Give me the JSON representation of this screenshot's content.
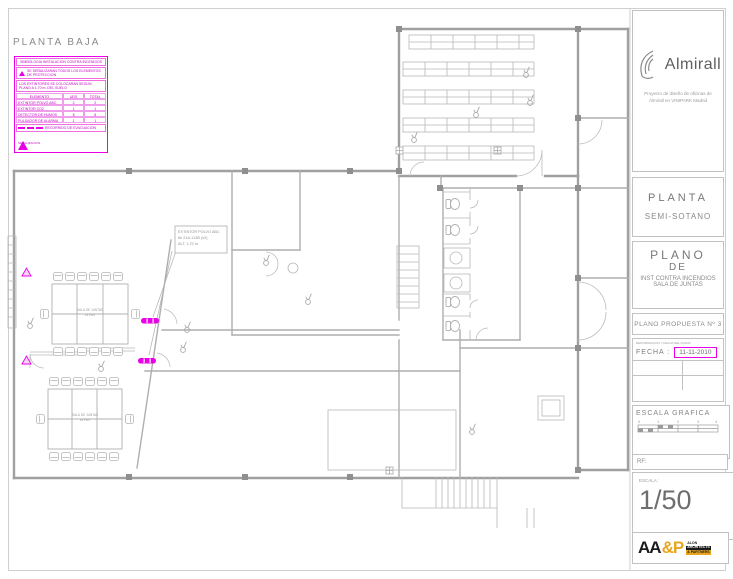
{
  "sheet_title": "PLANTA BAJA",
  "legend": {
    "title": "SIMBOLOGIA INSTALACION CONTRA INCENDIOS",
    "warn_text": "SE SEÑALIZARAN TODOS LOS ELEMENTOS DE PROTECCION",
    "note_text": "LOS EXTINTORES SE COLOCARAN SEGUN PLANO A 1,70 m. DEL SUELO",
    "headers": [
      "ELEMENTO",
      "UDS",
      "TOTAL"
    ],
    "rows": [
      [
        "EXTINTOR POLVO ABC",
        "2",
        "2"
      ],
      [
        "EXTINTOR CO2",
        "1",
        "1"
      ],
      [
        "DETECTOR DE HUMOS",
        "8",
        "8"
      ],
      [
        "PULSADOR DE ALARMA",
        "1",
        "1"
      ]
    ],
    "evac_label": "RECORRIDO DE EVACUACION",
    "tri_caption": "SEÑALIZACION"
  },
  "plan": {
    "callout_lines": [
      "EXTINTOR POLVO ABC",
      "6e 21A-113B (x2)",
      "ALT. 1,70 m"
    ],
    "table1_label": "SALA DE JUNTAS",
    "table1_sub": "14 PAX",
    "table2_label": "SALA DE JUNTAS",
    "table2_sub": "14 PAX"
  },
  "titleblock": {
    "brand": {
      "name": "Almirall",
      "tagline1": "Proyecto de diseño de oficinas de",
      "tagline2": "Almirall en VINIPARK Madrid"
    },
    "planta": {
      "line1": "PLANTA",
      "line2": "SEMI-SOTANO"
    },
    "plano": {
      "line1": "PLANO",
      "line2": "DE",
      "line3": "INST CONTRA INCENDIOS",
      "line4": "SALA DE JUNTAS"
    },
    "proposal": "PLANO PROPUESTA Nº 3",
    "fecha": {
      "small": "DENOMINACION Y FECHA DEL PLANO",
      "label": "FECHA :",
      "value": "11-11-2010"
    },
    "escala_grafica": {
      "label": "ESCALA GRAFICA",
      "ticks": [
        "0",
        "1",
        "2",
        "3",
        "4"
      ]
    },
    "rf": "RF:",
    "escala": {
      "label": "ESCALA :",
      "value": "1/50"
    },
    "firm": {
      "aa": "AA",
      "p": "&P",
      "line1": "ALON",
      "line2": "ARCHITECTS",
      "line3": "& PARTNERS"
    }
  },
  "colors": {
    "magenta": "#e800e8",
    "gold": "#e8a61e",
    "line_gray": "#a0a0a0"
  }
}
